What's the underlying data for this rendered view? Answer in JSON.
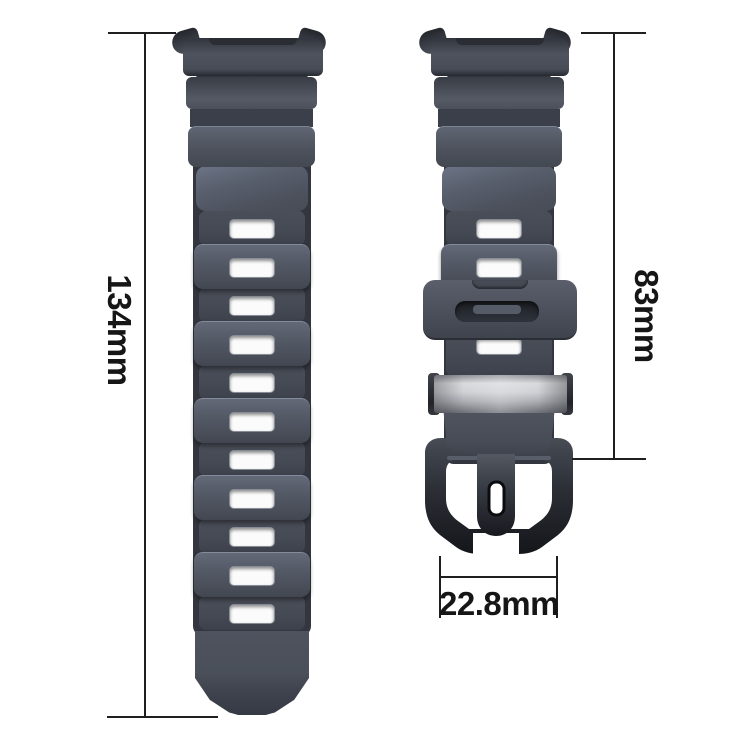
{
  "annotations": {
    "left_band_length": "134mm",
    "right_band_length": "83mm",
    "band_width": "22.8mm"
  },
  "subject": {
    "left_part": "long watch band with pin holes",
    "right_part": "short watch band with keeper loop, metal slider and buckle"
  },
  "colors": {
    "background": "#ffffff",
    "band_gray": "#4c515c",
    "band_dark_base": "#33363e",
    "hole_white": "#fbfbfb",
    "keeper_slot": "#22252b",
    "slider_silver": "#cfd1d5",
    "buckle_black": "#16181d",
    "dimension_line": "#1f1f1f",
    "label_text": "#161616"
  }
}
